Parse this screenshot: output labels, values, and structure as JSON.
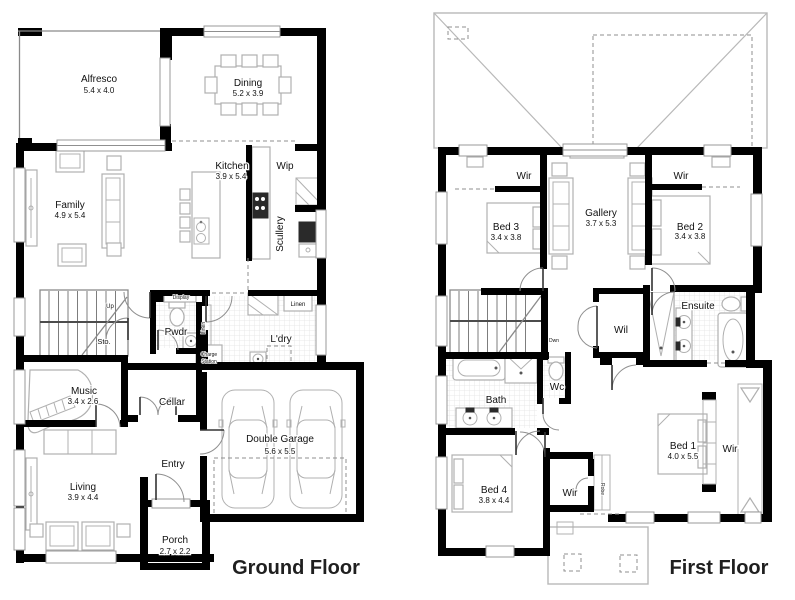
{
  "titles": {
    "ground_floor": "Ground Floor",
    "first_floor": "First Floor"
  },
  "ground_floor": {
    "alfresco": {
      "name": "Alfresco",
      "dims": "5.4 x 4.0"
    },
    "dining": {
      "name": "Dining",
      "dims": "5.2 x 3.9"
    },
    "kitchen": {
      "name": "Kitchen",
      "dims": "3.9 x 5.4"
    },
    "wip": {
      "name": "Wip"
    },
    "scullery": {
      "name": "Scullery"
    },
    "family": {
      "name": "Family",
      "dims": "4.9 x 5.4"
    },
    "up_label": "Up",
    "sto": {
      "name": "Sto."
    },
    "display_label": "Display",
    "linen_closet": "Linen",
    "charge_station": [
      "Charge",
      "Station"
    ],
    "pwdr": {
      "name": "Pwdr"
    },
    "linen_ldry": "Linen",
    "ldry": {
      "name": "L'dry"
    },
    "music": {
      "name": "Music",
      "dims": "3.4 x 2.6"
    },
    "cellar": {
      "name": "Cellar"
    },
    "entry": {
      "name": "Entry"
    },
    "garage": {
      "name": "Double Garage",
      "dims": "5.6 x 5.5"
    },
    "living": {
      "name": "Living",
      "dims": "3.9 x 4.4"
    },
    "porch": {
      "name": "Porch",
      "dims": "2.7 x 2.2"
    }
  },
  "first_floor": {
    "wir_bed3": "Wir",
    "bed3": {
      "name": "Bed 3",
      "dims": "3.4 x 3.8"
    },
    "gallery": {
      "name": "Gallery",
      "dims": "3.7 x 5.3"
    },
    "wir_bed2": "Wir",
    "bed2": {
      "name": "Bed 2",
      "dims": "3.4 x 3.8"
    },
    "dwn_label": "Dwn",
    "wil": {
      "name": "Wil"
    },
    "ensuite": {
      "name": "Ensuite"
    },
    "bath": {
      "name": "Bath"
    },
    "wc": {
      "name": "Wc"
    },
    "bed1": {
      "name": "Bed 1",
      "dims": "4.0 x 5.5"
    },
    "wir_bed1": "Wir",
    "bed4": {
      "name": "Bed 4",
      "dims": "3.8 x 4.4"
    },
    "wir_bed4": "Wir",
    "robe": "Robe"
  },
  "colors": {
    "wall": "#000000",
    "furniture": "#b0b0b0",
    "tile": "#e2e2e2",
    "title": "#1f1f1f"
  }
}
